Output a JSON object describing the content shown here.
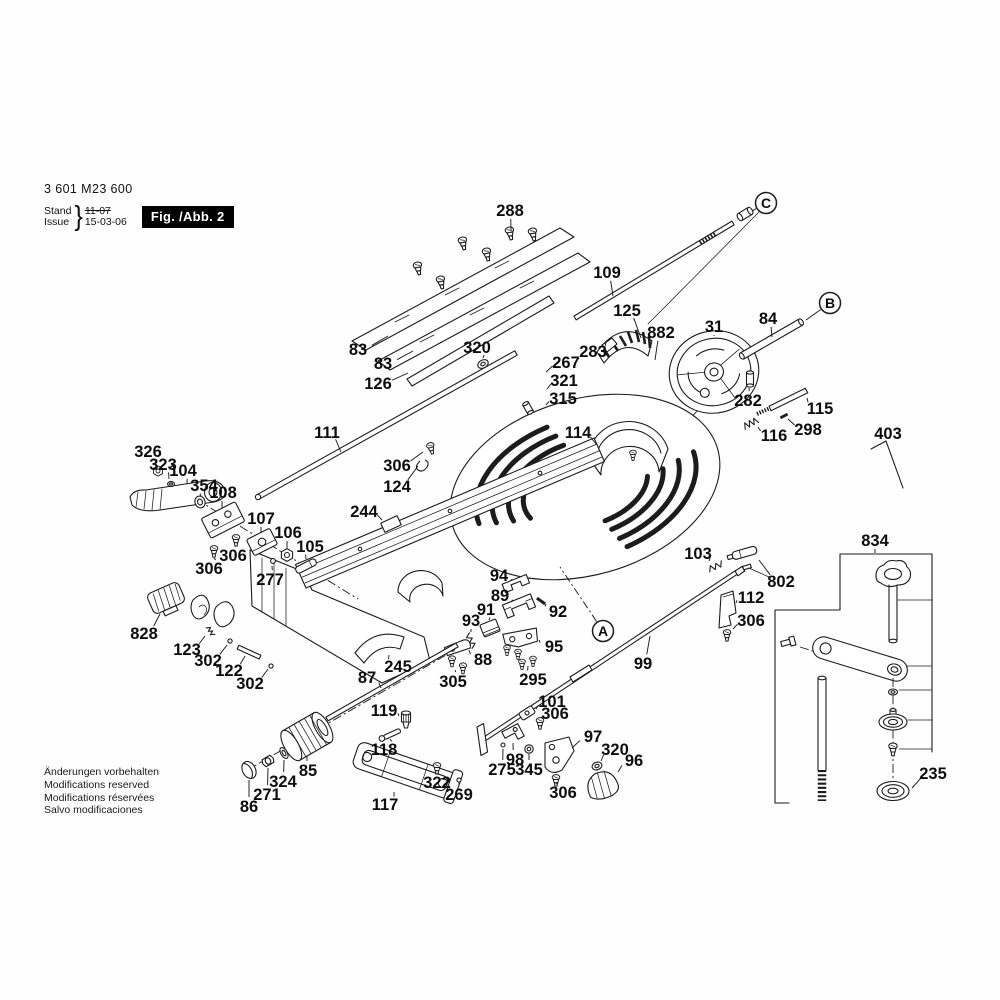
{
  "header": {
    "part_number": "3 601 M23 600",
    "stand_label": "Stand",
    "issue_label": "Issue",
    "stand_value": "11-07",
    "issue_value": "15-03-06",
    "fig_label": "Fig. /Abb. 2"
  },
  "footer": {
    "lines": [
      "Änderungen vorbehalten",
      "Modifications reserved",
      "Modifications réservées",
      "Salvo modificaciones"
    ]
  },
  "colors": {
    "ink": "#1c1c1c",
    "fig_box_bg": "#000000",
    "fig_box_text": "#ffffff"
  },
  "diagram": {
    "labels": [
      {
        "t": "288",
        "x": 510,
        "y": 210,
        "lx": 511,
        "ly": 230
      },
      {
        "t": "109",
        "x": 607,
        "y": 272,
        "lx": 613,
        "ly": 296
      },
      {
        "t": "125",
        "x": 627,
        "y": 310,
        "lx": 641,
        "ly": 338
      },
      {
        "t": "882",
        "x": 661,
        "y": 332,
        "lx": 655,
        "ly": 360
      },
      {
        "t": "283",
        "x": 593,
        "y": 351,
        "lx": 606,
        "ly": 342
      },
      {
        "t": "31",
        "x": 714,
        "y": 326,
        "lx": 714,
        "ly": 336
      },
      {
        "t": "84",
        "x": 768,
        "y": 318,
        "lx": 772,
        "ly": 337
      },
      {
        "t": "83",
        "x": 358,
        "y": 349,
        "lx": 388,
        "ly": 336
      },
      {
        "t": "83",
        "x": 383,
        "y": 363,
        "lx": 413,
        "ly": 351
      },
      {
        "t": "320",
        "x": 477,
        "y": 347,
        "lx": 483,
        "ly": 358
      },
      {
        "t": "126",
        "x": 378,
        "y": 383,
        "lx": 408,
        "ly": 373
      },
      {
        "t": "267",
        "x": 566,
        "y": 362,
        "lx": 546,
        "ly": 372
      },
      {
        "t": "321",
        "x": 564,
        "y": 380,
        "lx": 547,
        "ly": 389
      },
      {
        "t": "315",
        "x": 563,
        "y": 398,
        "lx": 546,
        "ly": 405
      },
      {
        "t": "282",
        "x": 748,
        "y": 400,
        "lx": 749,
        "ly": 388
      },
      {
        "t": "115",
        "x": 820,
        "y": 408,
        "lx": 807,
        "ly": 398
      },
      {
        "t": "298",
        "x": 808,
        "y": 429,
        "lx": 788,
        "ly": 419
      },
      {
        "t": "116",
        "x": 774,
        "y": 435,
        "lx": 758,
        "ly": 427
      },
      {
        "t": "403",
        "x": 888,
        "y": 433,
        "lx": 887,
        "ly": 442
      },
      {
        "t": "111",
        "x": 327,
        "y": 432,
        "lx": 341,
        "ly": 452
      },
      {
        "t": "114",
        "x": 578,
        "y": 432,
        "lx": 596,
        "ly": 444
      },
      {
        "t": "306",
        "x": 397,
        "y": 465,
        "lx": 423,
        "ly": 452
      },
      {
        "t": "124",
        "x": 397,
        "y": 486,
        "lx": 418,
        "ly": 466
      },
      {
        "t": "326",
        "x": 148,
        "y": 451,
        "lx": 156,
        "ly": 466
      },
      {
        "t": "323",
        "x": 163,
        "y": 464,
        "lx": 169,
        "ly": 479
      },
      {
        "t": "104",
        "x": 183,
        "y": 470,
        "lx": 187,
        "ly": 484
      },
      {
        "t": "354",
        "x": 204,
        "y": 485,
        "lx": 201,
        "ly": 496
      },
      {
        "t": "108",
        "x": 223,
        "y": 492,
        "lx": 222,
        "ly": 508
      },
      {
        "t": "107",
        "x": 261,
        "y": 518,
        "lx": 261,
        "ly": 532
      },
      {
        "t": "106",
        "x": 288,
        "y": 532,
        "lx": 287,
        "ly": 548
      },
      {
        "t": "105",
        "x": 310,
        "y": 546,
        "lx": 306,
        "ly": 559
      },
      {
        "t": "306",
        "x": 233,
        "y": 555,
        "lx": 235,
        "ly": 546
      },
      {
        "t": "306",
        "x": 209,
        "y": 568,
        "lx": 214,
        "ly": 558
      },
      {
        "t": "277",
        "x": 270,
        "y": 579,
        "lx": 272,
        "ly": 566
      },
      {
        "t": "244",
        "x": 364,
        "y": 511,
        "lx": 382,
        "ly": 520
      },
      {
        "t": "103",
        "x": 698,
        "y": 553,
        "lx": 709,
        "ly": 561
      },
      {
        "t": "802",
        "x": 781,
        "y": 581,
        "lx": 759,
        "ly": 560
      },
      {
        "t": "834",
        "x": 875,
        "y": 540,
        "lx": 875,
        "ly": 553
      },
      {
        "t": "112",
        "x": 751,
        "y": 597,
        "lx": 736,
        "ly": 603
      },
      {
        "t": "306",
        "x": 751,
        "y": 620,
        "lx": 733,
        "ly": 629
      },
      {
        "t": "828",
        "x": 144,
        "y": 633,
        "lx": 160,
        "ly": 614
      },
      {
        "t": "123",
        "x": 187,
        "y": 649,
        "lx": 205,
        "ly": 636
      },
      {
        "t": "302",
        "x": 208,
        "y": 660,
        "lx": 227,
        "ly": 645
      },
      {
        "t": "122",
        "x": 229,
        "y": 670,
        "lx": 245,
        "ly": 656
      },
      {
        "t": "302",
        "x": 250,
        "y": 683,
        "lx": 268,
        "ly": 669
      },
      {
        "t": "94",
        "x": 499,
        "y": 575,
        "lx": 510,
        "ly": 581
      },
      {
        "t": "89",
        "x": 500,
        "y": 595,
        "lx": 511,
        "ly": 602
      },
      {
        "t": "92",
        "x": 558,
        "y": 611,
        "lx": 546,
        "ly": 604
      },
      {
        "t": "91",
        "x": 486,
        "y": 609,
        "lx": 489,
        "ly": 620
      },
      {
        "t": "93",
        "x": 471,
        "y": 620,
        "lx": 471,
        "ly": 632
      },
      {
        "t": "88",
        "x": 483,
        "y": 659,
        "lx": 469,
        "ly": 650
      },
      {
        "t": "305",
        "x": 453,
        "y": 681,
        "lx": 455,
        "ly": 670
      },
      {
        "t": "95",
        "x": 554,
        "y": 646,
        "lx": 539,
        "ly": 640
      },
      {
        "t": "295",
        "x": 533,
        "y": 679,
        "lx": 528,
        "ly": 666
      },
      {
        "t": "245",
        "x": 398,
        "y": 666,
        "lx": 389,
        "ly": 655
      },
      {
        "t": "87",
        "x": 367,
        "y": 677,
        "lx": 381,
        "ly": 688
      },
      {
        "t": "99",
        "x": 643,
        "y": 663,
        "lx": 650,
        "ly": 636
      },
      {
        "t": "119",
        "x": 384,
        "y": 710,
        "lx": 399,
        "ly": 716
      },
      {
        "t": "118",
        "x": 384,
        "y": 749,
        "lx": 390,
        "ly": 739
      },
      {
        "t": "85",
        "x": 308,
        "y": 770,
        "lx": 307,
        "ly": 756
      },
      {
        "t": "324",
        "x": 283,
        "y": 781,
        "lx": 284,
        "ly": 760
      },
      {
        "t": "271",
        "x": 267,
        "y": 794,
        "lx": 268,
        "ly": 768
      },
      {
        "t": "86",
        "x": 249,
        "y": 806,
        "lx": 249,
        "ly": 780
      },
      {
        "t": "117",
        "x": 385,
        "y": 804,
        "lx": 394,
        "ly": 792
      },
      {
        "t": "322",
        "x": 437,
        "y": 782,
        "lx": 437,
        "ly": 774
      },
      {
        "t": "269",
        "x": 459,
        "y": 794,
        "lx": 459,
        "ly": 783
      },
      {
        "t": "101",
        "x": 552,
        "y": 701,
        "lx": 536,
        "ly": 709
      },
      {
        "t": "306",
        "x": 555,
        "y": 713,
        "lx": 543,
        "ly": 719
      },
      {
        "t": "275",
        "x": 502,
        "y": 769,
        "lx": 503,
        "ly": 749
      },
      {
        "t": "98",
        "x": 515,
        "y": 759,
        "lx": 513,
        "ly": 743
      },
      {
        "t": "345",
        "x": 529,
        "y": 769,
        "lx": 529,
        "ly": 754
      },
      {
        "t": "97",
        "x": 593,
        "y": 736,
        "lx": 572,
        "ly": 748
      },
      {
        "t": "320",
        "x": 615,
        "y": 749,
        "lx": 601,
        "ly": 761
      },
      {
        "t": "96",
        "x": 634,
        "y": 760,
        "lx": 618,
        "ly": 772
      },
      {
        "t": "306",
        "x": 563,
        "y": 792,
        "lx": 558,
        "ly": 783
      },
      {
        "t": "235",
        "x": 933,
        "y": 773,
        "lx": 912,
        "ly": 788
      }
    ],
    "refs": [
      {
        "t": "A",
        "x": 603,
        "y": 631,
        "lx": 560,
        "ly": 567,
        "dash": true
      },
      {
        "t": "B",
        "x": 830,
        "y": 303,
        "lx": 806,
        "ly": 320
      },
      {
        "t": "C",
        "x": 766,
        "y": 203,
        "lx": 752,
        "ly": 211
      }
    ]
  }
}
